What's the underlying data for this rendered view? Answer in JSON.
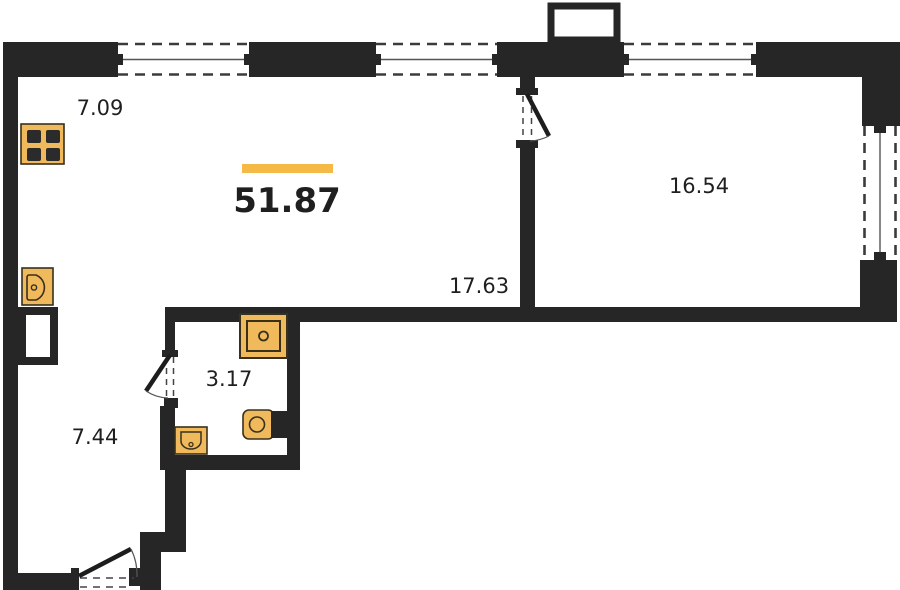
{
  "floor_plan": {
    "total": {
      "area": "51.87"
    },
    "rooms": [
      {
        "name": "kitchen-zone",
        "area": "7.09"
      },
      {
        "name": "living-room",
        "area": "17.63"
      },
      {
        "name": "bedroom",
        "area": "16.54"
      },
      {
        "name": "bathroom",
        "area": "3.17"
      },
      {
        "name": "hallway",
        "area": "7.44"
      }
    ],
    "fixtures": [
      "stove-icon",
      "kitchen-sink-icon",
      "vent-shaft",
      "shower-icon",
      "washbasin-icon",
      "toilet-icon"
    ],
    "colors": {
      "wall": "#262626",
      "accent_bar": "#F5B945",
      "fixture_fill": "#F0B95B",
      "fixture_stroke": "#38301C",
      "burner": "#2B2B2B",
      "text": "#1F1F1F"
    }
  }
}
